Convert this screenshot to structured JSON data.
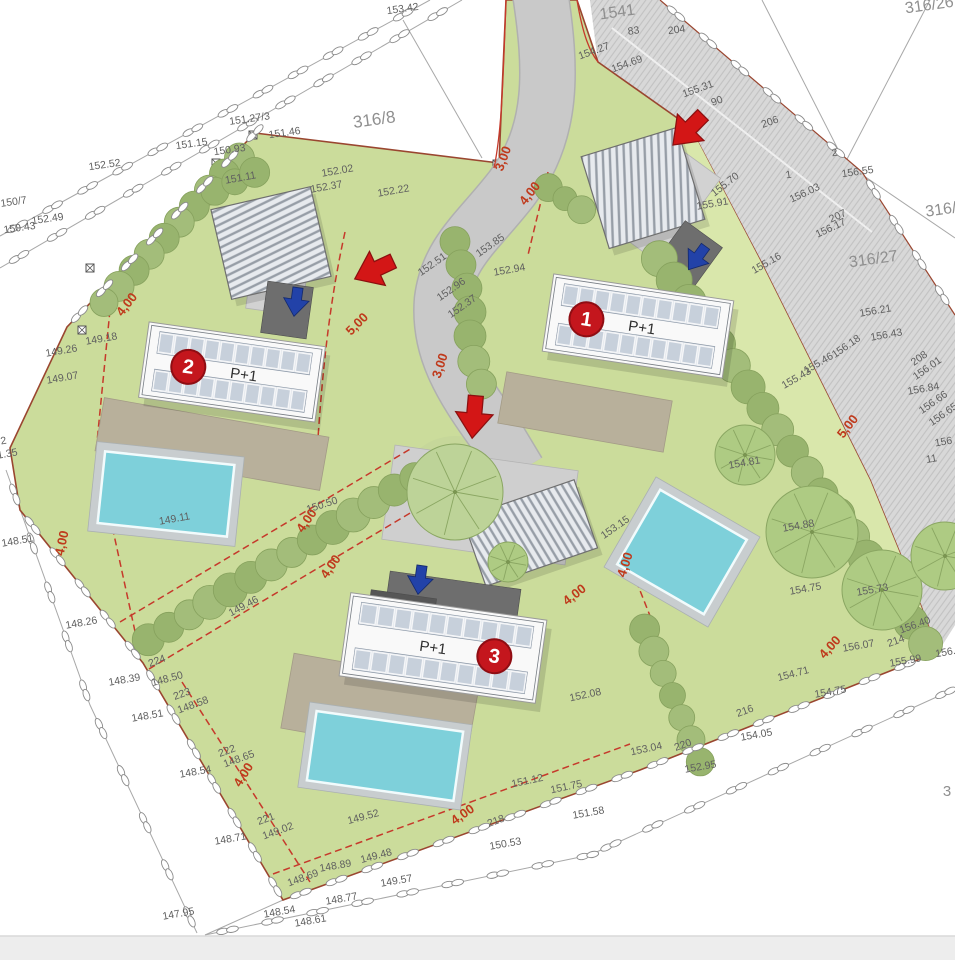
{
  "plan_title": "Villa site plan with three P+1 buildings",
  "villas": [
    {
      "badge": "1",
      "label": "P+1"
    },
    {
      "badge": "2",
      "label": "P+1"
    },
    {
      "badge": "3",
      "label": "P+1"
    }
  ],
  "parcel_labels": [
    [
      375,
      125,
      "316/8",
      -8,
      17
    ],
    [
      618,
      17,
      "1541",
      -8,
      16
    ],
    [
      930,
      10,
      "316/26",
      -8,
      16
    ],
    [
      946,
      214,
      "316/2",
      -8,
      16
    ],
    [
      874,
      264,
      "316/27",
      -8,
      16
    ],
    [
      947,
      796,
      "3",
      0,
      15
    ]
  ],
  "elevation_labels": [
    [
      403,
      12,
      "153.42"
    ],
    [
      105,
      168,
      "152.52"
    ],
    [
      48,
      222,
      "152.49"
    ],
    [
      250,
      122,
      "151.27/3"
    ],
    [
      285,
      136,
      "151.46"
    ],
    [
      192,
      147,
      "151.15"
    ],
    [
      230,
      153,
      "150.93"
    ],
    [
      241,
      181,
      "151.11",
      -10
    ],
    [
      14,
      205,
      "150/7"
    ],
    [
      20,
      231,
      "150.43"
    ],
    [
      634,
      34,
      "83"
    ],
    [
      677,
      33,
      "204"
    ],
    [
      595,
      54,
      "154.27",
      -20
    ],
    [
      628,
      67,
      "154.69",
      -20
    ],
    [
      699,
      92,
      "155.31",
      -20
    ],
    [
      718,
      104,
      "90",
      -20
    ],
    [
      771,
      125,
      "206",
      -20
    ],
    [
      835,
      156,
      "2"
    ],
    [
      858,
      175,
      "156.55"
    ],
    [
      789,
      178,
      "1"
    ],
    [
      806,
      196,
      "156.03",
      -25
    ],
    [
      839,
      219,
      "207",
      -25
    ],
    [
      832,
      231,
      "156.17",
      -25
    ],
    [
      727,
      187,
      "155.70",
      -38
    ],
    [
      713,
      207,
      "155.91",
      -10
    ],
    [
      768,
      266,
      "155.16",
      -30
    ],
    [
      876,
      314,
      "156.21",
      -10
    ],
    [
      848,
      349,
      "156.18",
      -35
    ],
    [
      887,
      338,
      "156.43",
      -10
    ],
    [
      921,
      361,
      "208",
      -35
    ],
    [
      929,
      371,
      "156.01",
      -35
    ],
    [
      924,
      392,
      "156.84",
      -10
    ],
    [
      935,
      405,
      "156.66",
      -35
    ],
    [
      945,
      417,
      "156.65",
      -35
    ],
    [
      944,
      445,
      "156",
      -10
    ],
    [
      932,
      462,
      "11",
      -10
    ],
    [
      798,
      381,
      "155.43",
      -30
    ],
    [
      820,
      366,
      "155.46",
      -30
    ],
    [
      745,
      466,
      "154.81",
      -10
    ],
    [
      799,
      529,
      "154.88",
      -10
    ],
    [
      806,
      592,
      "154.75",
      -10
    ],
    [
      873,
      593,
      "155.73",
      -10
    ],
    [
      916,
      628,
      "156.40",
      -20
    ],
    [
      897,
      644,
      "214",
      -20
    ],
    [
      859,
      649,
      "156.07",
      -10
    ],
    [
      949,
      655,
      "156.3",
      -10
    ],
    [
      906,
      664,
      "155.99",
      -10
    ],
    [
      831,
      695,
      "154.75",
      -10
    ],
    [
      794,
      677,
      "154.71",
      -15
    ],
    [
      757,
      738,
      "154.05",
      -10
    ],
    [
      647,
      752,
      "153.04",
      -12
    ],
    [
      684,
      748,
      "220",
      -20
    ],
    [
      701,
      770,
      "152.95",
      -10
    ],
    [
      589,
      816,
      "151.58",
      -10
    ],
    [
      528,
      784,
      "151.12",
      -12
    ],
    [
      567,
      790,
      "151.75",
      -12
    ],
    [
      506,
      847,
      "150.53",
      -10
    ],
    [
      497,
      824,
      "218",
      -20
    ],
    [
      746,
      714,
      "216",
      -20
    ],
    [
      377,
      859,
      "149.48",
      -15
    ],
    [
      336,
      869,
      "148.89",
      -10
    ],
    [
      397,
      884,
      "149.57",
      -10
    ],
    [
      342,
      902,
      "148.77",
      -10
    ],
    [
      304,
      881,
      "148.69",
      -20
    ],
    [
      280,
      915,
      "148.54",
      -10
    ],
    [
      311,
      924,
      "148.61",
      -10
    ],
    [
      179,
      917,
      "147.95",
      -10
    ],
    [
      267,
      822,
      "221",
      -20
    ],
    [
      279,
      834,
      "149.02",
      -20
    ],
    [
      231,
      842,
      "148.71",
      -10
    ],
    [
      196,
      775,
      "148.54",
      -10
    ],
    [
      228,
      754,
      "222",
      -20
    ],
    [
      240,
      762,
      "148.65",
      -20
    ],
    [
      148,
      719,
      "148.51",
      -10
    ],
    [
      183,
      697,
      "223",
      -20
    ],
    [
      194,
      708,
      "148.58",
      -20
    ],
    [
      158,
      664,
      "224",
      -20
    ],
    [
      168,
      682,
      "148.50",
      -15
    ],
    [
      125,
      683,
      "148.39",
      -10
    ],
    [
      82,
      626,
      "148.26",
      -10
    ],
    [
      18,
      544,
      "148.51",
      -10
    ],
    [
      175,
      522,
      "149.11",
      -10
    ],
    [
      245,
      609,
      "149.46",
      -28
    ],
    [
      63,
      381,
      "149.07",
      -10
    ],
    [
      62,
      354,
      "149.26",
      -10
    ],
    [
      102,
      342,
      "149.18",
      -10
    ],
    [
      4,
      444,
      "2",
      -10
    ],
    [
      8,
      457,
      "1.35",
      -10
    ],
    [
      323,
      508,
      "150.50",
      -18
    ],
    [
      492,
      248,
      "153.85",
      -35
    ],
    [
      510,
      273,
      "152.94",
      -10
    ],
    [
      434,
      267,
      "152.51",
      -35
    ],
    [
      453,
      292,
      "152.96",
      -35
    ],
    [
      464,
      309,
      "152.37",
      -35
    ],
    [
      327,
      190,
      "152.37",
      -10
    ],
    [
      338,
      174,
      "152.02",
      -10
    ],
    [
      394,
      194,
      "152.22",
      -10
    ],
    [
      586,
      698,
      "152.08",
      -12
    ],
    [
      617,
      530,
      "153.15",
      -35
    ],
    [
      364,
      820,
      "149.52",
      -15
    ]
  ],
  "dimension_labels": [
    [
      507,
      160,
      -70,
      "3,00"
    ],
    [
      444,
      367,
      -72,
      "3,00"
    ],
    [
      533,
      196,
      -52,
      "4,00"
    ],
    [
      130,
      307,
      -52,
      "4,00"
    ],
    [
      66,
      544,
      -78,
      "4,00"
    ],
    [
      310,
      523,
      -55,
      "4,00"
    ],
    [
      334,
      569,
      -55,
      "4,00"
    ],
    [
      629,
      566,
      -72,
      "4,00"
    ],
    [
      577,
      598,
      -38,
      "4,00"
    ],
    [
      465,
      818,
      -35,
      "4,00"
    ],
    [
      247,
      777,
      -58,
      "4,00"
    ],
    [
      833,
      650,
      -48,
      "4,00"
    ],
    [
      360,
      327,
      -45,
      "5,00"
    ],
    [
      851,
      429,
      -52,
      "5,00"
    ]
  ],
  "colors": {
    "lawn": "#cbdc9b",
    "lawn_strip": "#d9e7ab",
    "road": "#c9c9c9",
    "street": "#d8d8d8",
    "pool": "#7ed0da",
    "terrace": "#b8b09b",
    "badge": "#c4161d",
    "dimension": "#bf3a1c",
    "boundary": "#9a4630",
    "setback_dash": "#c6392b",
    "blue_arrow": "#2242a8",
    "red_arrow": "#d31616"
  }
}
